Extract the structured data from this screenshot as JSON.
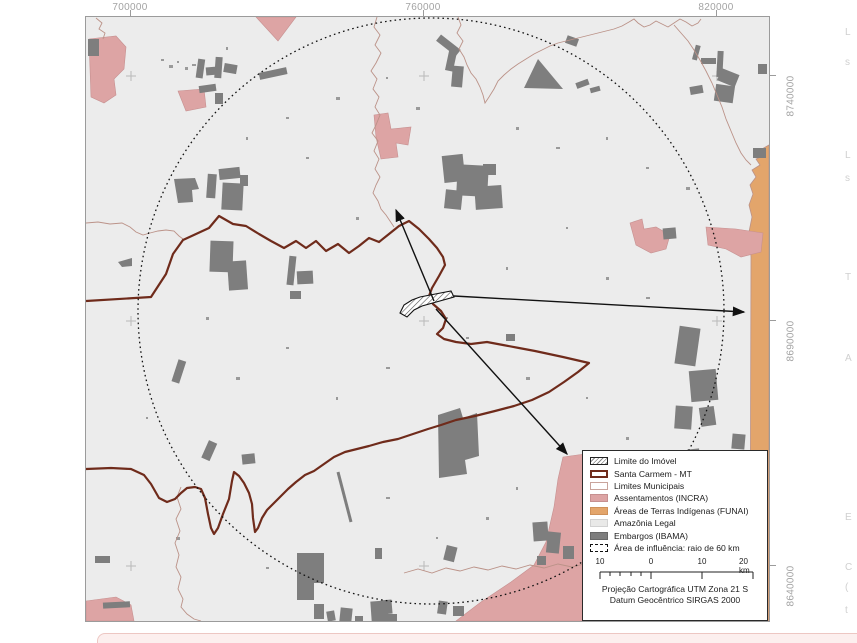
{
  "map": {
    "title_hint": "Municipal environmental context map",
    "axes": {
      "top": [
        "700000",
        "760000",
        "820000"
      ],
      "right": [
        "8740000",
        "8690000",
        "8640000"
      ]
    },
    "legend": {
      "items": [
        {
          "label": "Limite do Imóvel",
          "swatch": "hatched"
        },
        {
          "label": "Santa Carmem - MT",
          "swatch": "dark-red-outline"
        },
        {
          "label": "Limites Municipais",
          "swatch": "thin-pink-outline"
        },
        {
          "label": "Assentamentos (INCRA)",
          "swatch": "pink-fill"
        },
        {
          "label": "Áreas de Terras Indígenas (FUNAI)",
          "swatch": "orange-fill"
        },
        {
          "label": "Amazônia Legal",
          "swatch": "light-gray-fill"
        },
        {
          "label": "Embargos (IBAMA)",
          "swatch": "dark-gray-fill"
        },
        {
          "label": "Área de influência: raio de 60 km",
          "swatch": "dashed-outline"
        }
      ],
      "scale_bar": {
        "tick_labels": [
          "10",
          "0",
          "10"
        ],
        "end_label": "20 km"
      },
      "projection": [
        "Projeção Cartográfica UTM Zona 21 S",
        "Datum Geocêntrico SIRGAS 2000"
      ]
    },
    "colors": {
      "amazonia_legal_fill": "#ececec",
      "assentamentos_fill": "#dda4a4",
      "terras_indigenas_fill": "#e3a56b",
      "embargos_fill": "#7e7e7e",
      "santa_carmem_line": "#6f2b1b",
      "limites_municipais_line": "#bb9288",
      "influence_circle_line": "#111111"
    },
    "margin_letters": [
      {
        "ch": "L",
        "y": 27
      },
      {
        "ch": "s",
        "y": 57
      },
      {
        "ch": "L",
        "y": 150
      },
      {
        "ch": "s",
        "y": 173
      },
      {
        "ch": "T",
        "y": 272
      },
      {
        "ch": "A",
        "y": 353
      },
      {
        "ch": "E",
        "y": 512
      },
      {
        "ch": "C",
        "y": 562
      },
      {
        "ch": "(",
        "y": 582
      },
      {
        "ch": "t",
        "y": 605
      }
    ]
  }
}
